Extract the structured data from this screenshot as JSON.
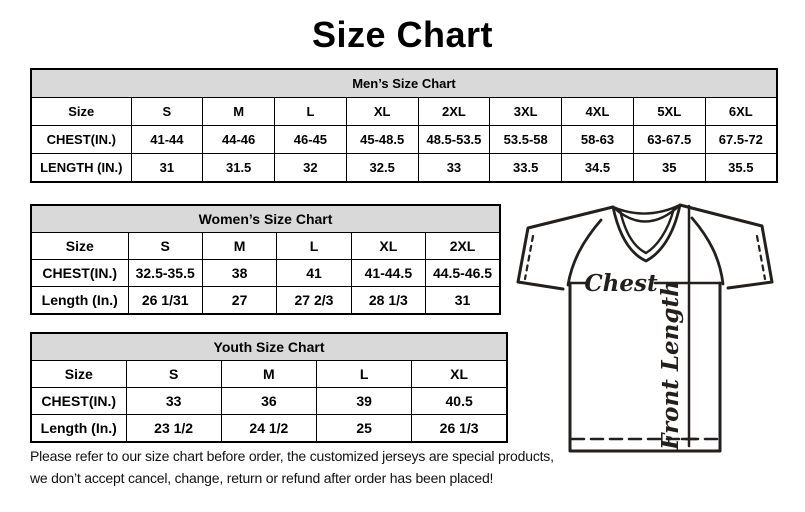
{
  "page": {
    "title": "Size Chart"
  },
  "colors": {
    "table_header_bg": "#d9d9d9",
    "table_border": "#000000",
    "text": "#000000",
    "shirt_line": "#231f1c"
  },
  "tables": {
    "mens": {
      "title": "Men’s Size Chart",
      "rows": [
        {
          "label": "Size",
          "values": [
            "S",
            "M",
            "L",
            "XL",
            "2XL",
            "3XL",
            "4XL",
            "5XL",
            "6XL"
          ]
        },
        {
          "label": "CHEST(IN.)",
          "values": [
            "41-44",
            "44-46",
            "46-45",
            "45-48.5",
            "48.5-53.5",
            "53.5-58",
            "58-63",
            "63-67.5",
            "67.5-72"
          ]
        },
        {
          "label": "LENGTH (IN.)",
          "values": [
            "31",
            "31.5",
            "32",
            "32.5",
            "33",
            "33.5",
            "34.5",
            "35",
            "35.5"
          ]
        }
      ]
    },
    "womens": {
      "title": "Women’s Size Chart",
      "rows": [
        {
          "label": "Size",
          "values": [
            "S",
            "M",
            "L",
            "XL",
            "2XL"
          ]
        },
        {
          "label": "CHEST(IN.)",
          "values": [
            "32.5-35.5",
            "38",
            "41",
            "41-44.5",
            "44.5-46.5"
          ]
        },
        {
          "label": "Length (In.)",
          "values": [
            "26 1/31",
            "27",
            "27 2/3",
            "28 1/3",
            "31"
          ]
        }
      ]
    },
    "youth": {
      "title": "Youth Size Chart",
      "rows": [
        {
          "label": "Size",
          "values": [
            "S",
            "M",
            "L",
            "XL"
          ]
        },
        {
          "label": "CHEST(IN.)",
          "values": [
            "33",
            "36",
            "39",
            "40.5"
          ]
        },
        {
          "label": "Length (In.)",
          "values": [
            "23 1/2",
            "24 1/2",
            "25",
            "26 1/3"
          ]
        }
      ]
    }
  },
  "diagram": {
    "chest_label": "Chest",
    "front_length_label": "Front Length"
  },
  "disclaimer": {
    "line1": "Please refer to our size chart before order, the customized jerseys are special products,",
    "line2": "we don’t accept cancel, change, return or refund after order has been placed!"
  }
}
